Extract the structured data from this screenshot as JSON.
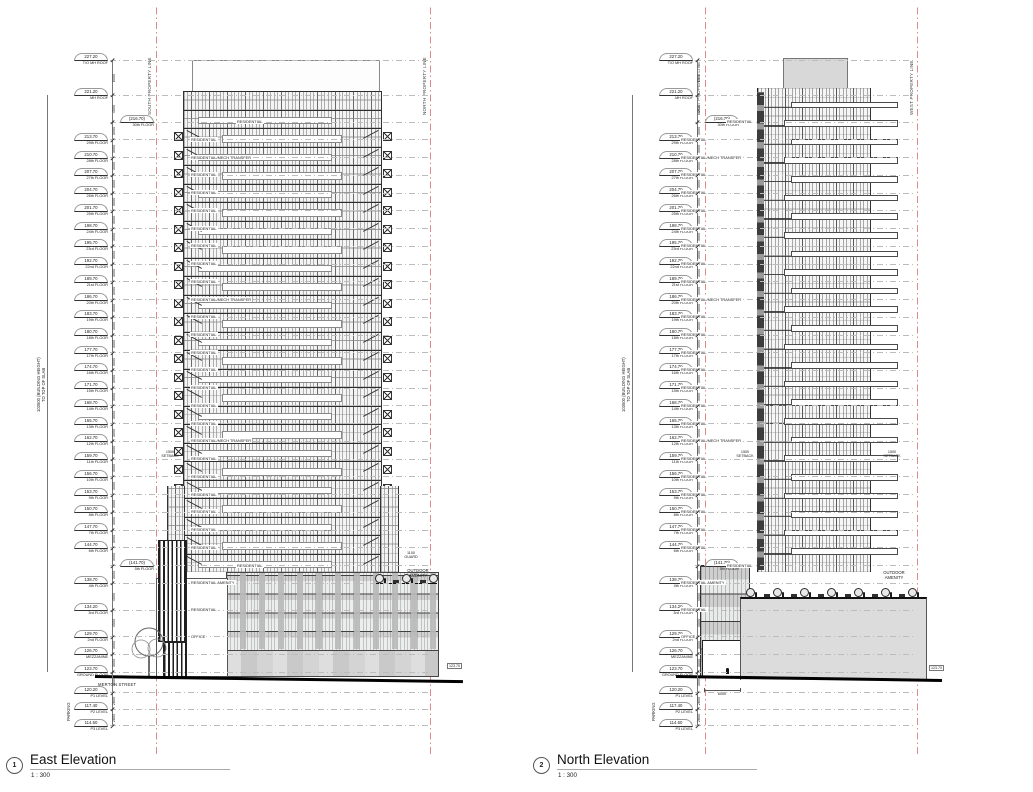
{
  "drawing": {
    "height_dim_label": "103500 (BUILDING HEIGHT)\nTO TOP OF SLAB",
    "parking_label": "PARKING",
    "levels": [
      {
        "elev": 227.2,
        "value": "227.20",
        "name": "T/O MH ROOF",
        "label": "",
        "dim": "6000",
        "offset": false
      },
      {
        "elev": 221.2,
        "value": "221.20",
        "name": "MH ROOF",
        "label": "",
        "dim": "4500",
        "offset": false
      },
      {
        "elev": 216.7,
        "value": "216.70",
        "name": "30th FLOOR",
        "label": "RESIDENTIAL",
        "dim": "3000",
        "offset": true
      },
      {
        "elev": 213.7,
        "value": "213.70",
        "name": "29th FLOOR",
        "label": "RESIDENTIAL",
        "dim": "3000",
        "offset": false
      },
      {
        "elev": 210.7,
        "value": "210.70",
        "name": "28th FLOOR",
        "label": "RESIDENTIAL/MECH TRANSFER",
        "dim": "3000",
        "offset": false
      },
      {
        "elev": 207.7,
        "value": "207.70",
        "name": "27th FLOOR",
        "label": "RESIDENTIAL",
        "dim": "3000",
        "offset": false
      },
      {
        "elev": 204.7,
        "value": "204.70",
        "name": "26th FLOOR",
        "label": "RESIDENTIAL",
        "dim": "3000",
        "offset": false
      },
      {
        "elev": 201.7,
        "value": "201.70",
        "name": "25th FLOOR",
        "label": "RESIDENTIAL",
        "dim": "3000",
        "offset": false
      },
      {
        "elev": 198.7,
        "value": "198.70",
        "name": "24th FLOOR",
        "label": "RESIDENTIAL",
        "dim": "3000",
        "offset": false
      },
      {
        "elev": 195.7,
        "value": "195.70",
        "name": "23rd FLOOR",
        "label": "RESIDENTIAL",
        "dim": "3000",
        "offset": false
      },
      {
        "elev": 192.7,
        "value": "192.70",
        "name": "22nd FLOOR",
        "label": "RESIDENTIAL",
        "dim": "3000",
        "offset": false
      },
      {
        "elev": 189.7,
        "value": "189.70",
        "name": "21st FLOOR",
        "label": "RESIDENTIAL",
        "dim": "3000",
        "offset": false
      },
      {
        "elev": 186.7,
        "value": "186.70",
        "name": "20th FLOOR",
        "label": "RESIDENTIAL/MECH TRANSFER",
        "dim": "3000",
        "offset": false
      },
      {
        "elev": 183.7,
        "value": "183.70",
        "name": "19th FLOOR",
        "label": "RESIDENTIAL",
        "dim": "3000",
        "offset": false
      },
      {
        "elev": 180.7,
        "value": "180.70",
        "name": "18th FLOOR",
        "label": "RESIDENTIAL",
        "dim": "3000",
        "offset": false
      },
      {
        "elev": 177.7,
        "value": "177.70",
        "name": "17th FLOOR",
        "label": "RESIDENTIAL",
        "dim": "3000",
        "offset": false
      },
      {
        "elev": 174.7,
        "value": "174.70",
        "name": "16th FLOOR",
        "label": "RESIDENTIAL",
        "dim": "3000",
        "offset": false
      },
      {
        "elev": 171.7,
        "value": "171.70",
        "name": "15th FLOOR",
        "label": "RESIDENTIAL",
        "dim": "3000",
        "offset": false
      },
      {
        "elev": 168.7,
        "value": "168.70",
        "name": "14th FLOOR",
        "label": "RESIDENTIAL",
        "dim": "3000",
        "offset": false
      },
      {
        "elev": 165.7,
        "value": "165.70",
        "name": "13th FLOOR",
        "label": "RESIDENTIAL",
        "dim": "3000",
        "offset": false
      },
      {
        "elev": 162.7,
        "value": "162.70",
        "name": "12th FLOOR",
        "label": "RESIDENTIAL/MECH TRANSFER",
        "dim": "3000",
        "offset": false
      },
      {
        "elev": 159.7,
        "value": "159.70",
        "name": "11th FLOOR",
        "label": "RESIDENTIAL",
        "dim": "3000",
        "offset": false
      },
      {
        "elev": 156.7,
        "value": "156.70",
        "name": "10th FLOOR",
        "label": "RESIDENTIAL",
        "dim": "3000",
        "offset": false
      },
      {
        "elev": 153.7,
        "value": "153.70",
        "name": "9th FLOOR",
        "label": "RESIDENTIAL",
        "dim": "3000",
        "offset": false
      },
      {
        "elev": 150.7,
        "value": "150.70",
        "name": "8th FLOOR",
        "label": "RESIDENTIAL",
        "dim": "3000",
        "offset": false
      },
      {
        "elev": 147.7,
        "value": "147.70",
        "name": "7th FLOOR",
        "label": "RESIDENTIAL",
        "dim": "3000",
        "offset": false
      },
      {
        "elev": 144.7,
        "value": "144.70",
        "name": "6th FLOOR",
        "label": "RESIDENTIAL",
        "dim": "3000",
        "offset": false
      },
      {
        "elev": 141.7,
        "value": "141.70",
        "name": "5th FLOOR",
        "label": "RESIDENTIAL",
        "dim": "3000",
        "offset": true
      },
      {
        "elev": 138.7,
        "value": "138.70",
        "name": "4th FLOOR",
        "label": "RESIDENTIAL AMENITY",
        "dim": "4500",
        "offset": false
      },
      {
        "elev": 134.2,
        "value": "134.20",
        "name": "3rd FLOOR",
        "label": "RESIDENTIAL",
        "dim": "4500",
        "offset": false
      },
      {
        "elev": 129.7,
        "value": "129.70",
        "name": "2nd FLOOR",
        "label": "OFFICE",
        "dim": "3000",
        "offset": false
      },
      {
        "elev": 126.7,
        "value": "126.70",
        "name": "MEZZANINE",
        "label": "",
        "dim": "3000",
        "offset": false
      },
      {
        "elev": 123.7,
        "value": "123.70",
        "name": "GROUND FLOOR",
        "label": "",
        "dim": "3500",
        "offset": false
      },
      {
        "elev": 120.2,
        "value": "120.20",
        "name": "P1 LEVEL",
        "label": "",
        "dim": "2800",
        "offset": false
      },
      {
        "elev": 117.4,
        "value": "117.40",
        "name": "P2 LEVEL",
        "label": "",
        "dim": "2800",
        "offset": false
      },
      {
        "elev": 114.6,
        "value": "114.60",
        "name": "P3 LEVEL",
        "label": "",
        "dim": "",
        "offset": false
      }
    ],
    "views": [
      {
        "number": "1",
        "title": "East Elevation",
        "scale": "1 : 300",
        "property_line_left": "SOUTH PROPERTY LINE",
        "property_line_right": "NORTH PROPERTY LINE",
        "street_label": "MERTON STREET",
        "amenity_label": "OUTDOOR\nAMENITY",
        "guard_dim": "1100\nGUARD",
        "setback_dim": "1500\nSETBACK",
        "spot_elevation": "123.70"
      },
      {
        "number": "2",
        "title": "North Elevation",
        "scale": "1 : 300",
        "property_line_left": "EAST PROPERTY LINE",
        "property_line_right": "WEST PROPERTY LINE",
        "amenity_label": "OUTDOOR\nAMENITY",
        "driveway_dim": "6000",
        "setback_dim": "1500\nSETBACK",
        "spot_elevation": "123.70"
      }
    ]
  }
}
